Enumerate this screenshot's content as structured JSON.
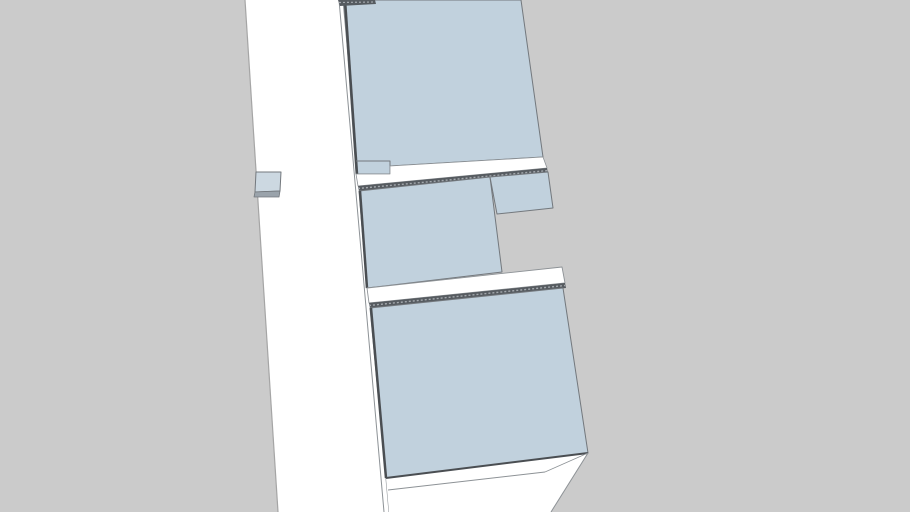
{
  "viewport": {
    "width": 910,
    "height": 512,
    "background_color": "#cbcbcb",
    "palette": {
      "surface_white": "#ffffff",
      "glass_blue": "#c1d1dd",
      "edge_thin": "#73787d",
      "edge_soft": "#8d9296",
      "edge_thick": "#4a4e52",
      "hatch_dark": "#565b60",
      "hatch_dot": "#a3a8ad",
      "background_edge": "#a5a5a5",
      "tab_face": "#ccd8e1",
      "tab_shade": "#9aa3ab"
    },
    "shapes": [
      {
        "name": "wall-slab-face",
        "type": "polygon",
        "points": [
          [
            245,
            0
          ],
          [
            343,
            0
          ],
          [
            389,
            512
          ],
          [
            278,
            512
          ]
        ],
        "fill": "surface_white",
        "interactable": true
      },
      {
        "name": "slab-left-silhouette-edge",
        "type": "polyline",
        "points": [
          [
            245,
            0
          ],
          [
            278,
            512
          ]
        ],
        "stroke": "background_edge",
        "width": 1.2
      },
      {
        "name": "slab-right-edge-inner",
        "type": "polyline",
        "points": [
          [
            339,
            0
          ],
          [
            384,
            512
          ]
        ],
        "stroke": "edge_soft",
        "width": 1
      },
      {
        "name": "slab-right-edge-outer",
        "type": "polyline",
        "points": [
          [
            343,
            0
          ],
          [
            389,
            512
          ]
        ],
        "stroke": "edge_soft",
        "width": 1
      },
      {
        "name": "left-tab-face",
        "type": "polygon",
        "points": [
          [
            256,
            172
          ],
          [
            281,
            172
          ],
          [
            280,
            191
          ],
          [
            255,
            192
          ]
        ],
        "fill": "tab_face",
        "stroke": "edge_thin",
        "width": 1,
        "interactable": true
      },
      {
        "name": "left-tab-bottom-shade",
        "type": "polygon",
        "points": [
          [
            255,
            192
          ],
          [
            280,
            191
          ],
          [
            279,
            197
          ],
          [
            254,
            197
          ]
        ],
        "fill": "tab_shade",
        "stroke": "edge_thin",
        "width": 0.8
      },
      {
        "name": "top-glass-panel",
        "type": "polygon",
        "points": [
          [
            344,
            0
          ],
          [
            521,
            0
          ],
          [
            543,
            157
          ],
          [
            390,
            166
          ],
          [
            390,
            174
          ],
          [
            356,
            174
          ]
        ],
        "fill": "glass_blue",
        "stroke": "edge_thin",
        "width": 1,
        "interactable": true
      },
      {
        "name": "top-panel-left-profile-edge",
        "type": "polyline",
        "points": [
          [
            345,
            0
          ],
          [
            357,
            174
          ]
        ],
        "stroke": "edge_thick",
        "width": 2.5
      },
      {
        "name": "top-panel-step-outline",
        "type": "polyline",
        "points": [
          [
            356,
            161
          ],
          [
            390,
            161
          ],
          [
            390,
            166
          ]
        ],
        "stroke": "edge_thin",
        "width": 1
      },
      {
        "name": "top-rail-face",
        "type": "polygon",
        "points": [
          [
            356,
            174
          ],
          [
            390,
            174
          ],
          [
            390,
            166
          ],
          [
            543,
            157
          ],
          [
            547,
            168
          ],
          [
            358,
            186
          ]
        ],
        "fill": "surface_white",
        "stroke": "edge_soft",
        "width": 0.8,
        "interactable": true
      },
      {
        "name": "top-rail-hatch-strip",
        "type": "polygon",
        "points": [
          [
            358,
            186
          ],
          [
            547,
            168
          ],
          [
            548,
            173
          ],
          [
            359,
            191
          ]
        ],
        "fill": "hatch_dark"
      },
      {
        "name": "top-rail-hatch-dots",
        "type": "polyline",
        "points": [
          [
            358,
            188.5
          ],
          [
            548,
            170.5
          ]
        ],
        "stroke": "hatch_dot",
        "width": 1.4,
        "dash": "2 2"
      },
      {
        "name": "viewport-top-hatch-fragment",
        "type": "polygon",
        "points": [
          [
            338,
            0
          ],
          [
            375,
            0
          ],
          [
            376,
            4
          ],
          [
            340,
            6
          ]
        ],
        "fill": "hatch_dark"
      },
      {
        "name": "viewport-top-hatch-fragment-dots",
        "type": "polyline",
        "points": [
          [
            339,
            2.5
          ],
          [
            375,
            2
          ]
        ],
        "stroke": "hatch_dot",
        "width": 1.2,
        "dash": "2 2"
      },
      {
        "name": "middle-glass-panel",
        "type": "polygon",
        "points": [
          [
            359,
            191
          ],
          [
            490,
            177
          ],
          [
            502,
            272
          ],
          [
            367,
            288
          ]
        ],
        "fill": "glass_blue",
        "stroke": "edge_thin",
        "width": 1,
        "interactable": true
      },
      {
        "name": "middle-panel-left-profile-edge",
        "type": "polyline",
        "points": [
          [
            360,
            191
          ],
          [
            367,
            288
          ]
        ],
        "stroke": "edge_thick",
        "width": 2.5
      },
      {
        "name": "middle-glass-panel-extension",
        "type": "polygon",
        "points": [
          [
            490,
            177
          ],
          [
            548,
            172
          ],
          [
            553,
            208
          ],
          [
            497,
            214
          ]
        ],
        "fill": "glass_blue",
        "stroke": "edge_thin",
        "width": 1,
        "interactable": true
      },
      {
        "name": "middle-rail-face",
        "type": "polygon",
        "points": [
          [
            367,
            288
          ],
          [
            562,
            267
          ],
          [
            565,
            283
          ],
          [
            369,
            303
          ]
        ],
        "fill": "surface_white",
        "stroke": "edge_soft",
        "width": 0.9,
        "interactable": true
      },
      {
        "name": "middle-rail-hatch-strip",
        "type": "polygon",
        "points": [
          [
            369,
            303
          ],
          [
            565,
            283
          ],
          [
            566,
            288
          ],
          [
            370,
            308
          ]
        ],
        "fill": "hatch_dark"
      },
      {
        "name": "middle-rail-hatch-dots",
        "type": "polyline",
        "points": [
          [
            369,
            305.5
          ],
          [
            565,
            285.5
          ]
        ],
        "stroke": "hatch_dot",
        "width": 1.4,
        "dash": "2 2"
      },
      {
        "name": "bottom-glass-panel",
        "type": "polygon",
        "points": [
          [
            370,
            308
          ],
          [
            563,
            288
          ],
          [
            588,
            453
          ],
          [
            386,
            478
          ]
        ],
        "fill": "glass_blue",
        "stroke": "edge_thin",
        "width": 1,
        "interactable": true
      },
      {
        "name": "bottom-panel-left-profile-edge",
        "type": "polyline",
        "points": [
          [
            371,
            308
          ],
          [
            386,
            478
          ]
        ],
        "stroke": "edge_thick",
        "width": 2.5
      },
      {
        "name": "bottom-sill-face",
        "type": "polygon",
        "points": [
          [
            386,
            478
          ],
          [
            588,
            453
          ],
          [
            551,
            512
          ],
          [
            389,
            512
          ]
        ],
        "fill": "surface_white",
        "interactable": true
      },
      {
        "name": "bottom-panel-bottom-edge",
        "type": "polyline",
        "points": [
          [
            386,
            478
          ],
          [
            588,
            453
          ]
        ],
        "stroke": "edge_thick",
        "width": 2
      },
      {
        "name": "sill-right-edge",
        "type": "polyline",
        "points": [
          [
            588,
            453
          ],
          [
            551,
            512
          ]
        ],
        "stroke": "edge_soft",
        "width": 1
      },
      {
        "name": "sill-front-edge",
        "type": "polyline",
        "points": [
          [
            388,
            490
          ],
          [
            545,
            472
          ]
        ],
        "stroke": "edge_soft",
        "width": 1
      },
      {
        "name": "sill-end-edge",
        "type": "polyline",
        "points": [
          [
            545,
            472
          ],
          [
            588,
            453
          ]
        ],
        "stroke": "edge_soft",
        "width": 0.8
      }
    ]
  }
}
